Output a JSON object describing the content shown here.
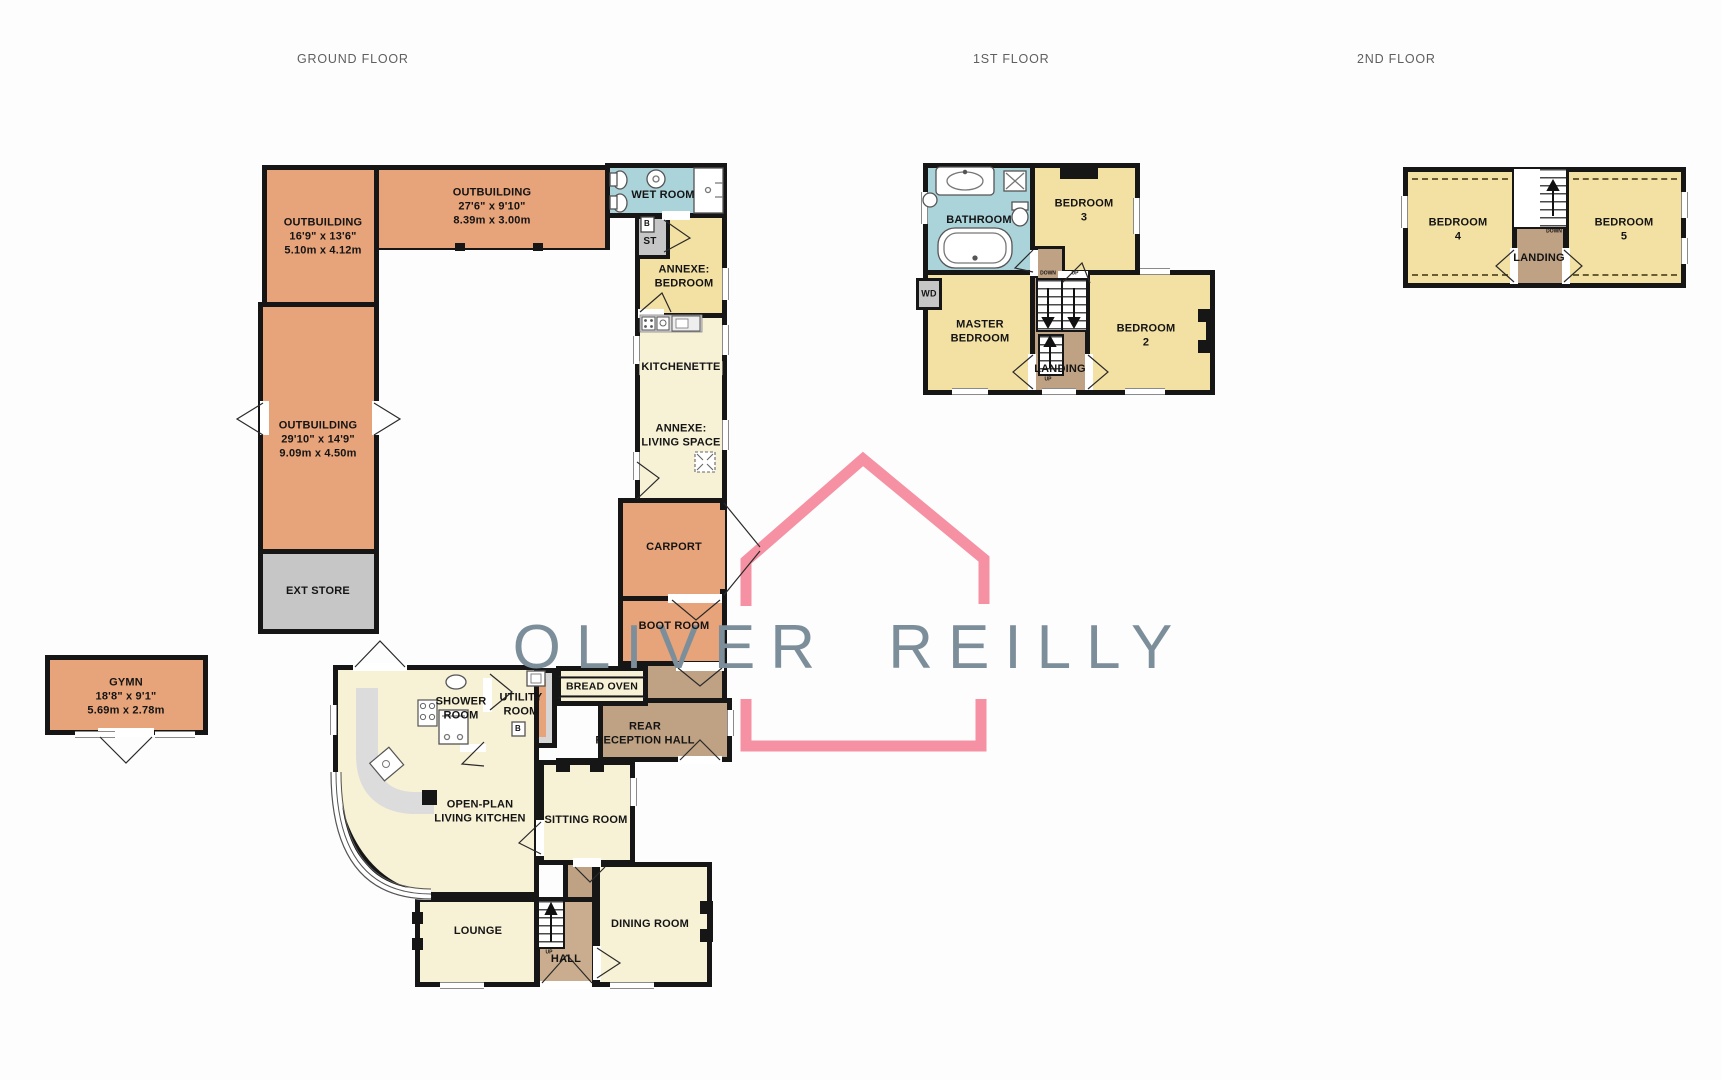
{
  "titles": {
    "ground": "GROUND FLOOR",
    "first": "1ST FLOOR",
    "second": "2ND FLOOR"
  },
  "brand": {
    "name": "OLIVER REILLY",
    "house_pink": "#f591a2",
    "text_grey": "#7d8e9b"
  },
  "colors": {
    "outbuilding_orange": "#e7a379",
    "main_cream": "#f7f1d6",
    "bedroom_yellow": "#f3e1a3",
    "bathroom_blue": "#abd3da",
    "store_grey": "#c6c6c6",
    "hall_brown": "#bfa183",
    "wall_black": "#161616"
  },
  "ground": {
    "outbuilding_a": "OUTBUILDING\n16'9\" x 13'6\"\n5.10m x 4.12m",
    "outbuilding_b": "OUTBUILDING\n27'6\" x 9'10\"\n8.39m x 3.00m",
    "outbuilding_c": "OUTBUILDING\n29'10\" x 14'9\"\n9.09m x 4.50m",
    "ext_store": "EXT STORE",
    "gym": "GYMN\n18'8\" x 9'1\"\n5.69m x 2.78m",
    "wet_room": "WET ROOM",
    "st": "ST",
    "boiler": "B",
    "annexe_bedroom": "ANNEXE:\nBEDROOM",
    "kitchenette": "KITCHENETTE",
    "annexe_living": "ANNEXE:\nLIVING SPACE",
    "carport": "CARPORT",
    "boot_room": "BOOT ROOM",
    "bread_oven": "BREAD OVEN",
    "rear_reception": "REAR\nRECEPTION HALL",
    "utility": "UTILITY\nROOM",
    "utility_boiler": "B",
    "shower_room": "SHOWER\nROOM",
    "open_plan": "OPEN-PLAN\nLIVING KITCHEN",
    "sitting": "SITTING ROOM",
    "lounge": "LOUNGE",
    "hall": "HALL",
    "dining": "DINING ROOM",
    "stairs_up": "UP"
  },
  "first": {
    "bathroom": "BATHROOM",
    "bedroom3": "BEDROOM\n3",
    "wd": "WD",
    "master": "MASTER\nBEDROOM",
    "landing": "LANDING",
    "bedroom2": "BEDROOM\n2",
    "stair_down": "DOWN",
    "stair_up": "UP",
    "stair_up2": "UP"
  },
  "second": {
    "bedroom4": "BEDROOM\n4",
    "landing": "LANDING",
    "bedroom5": "BEDROOM\n5",
    "stair_down": "DOWN"
  }
}
